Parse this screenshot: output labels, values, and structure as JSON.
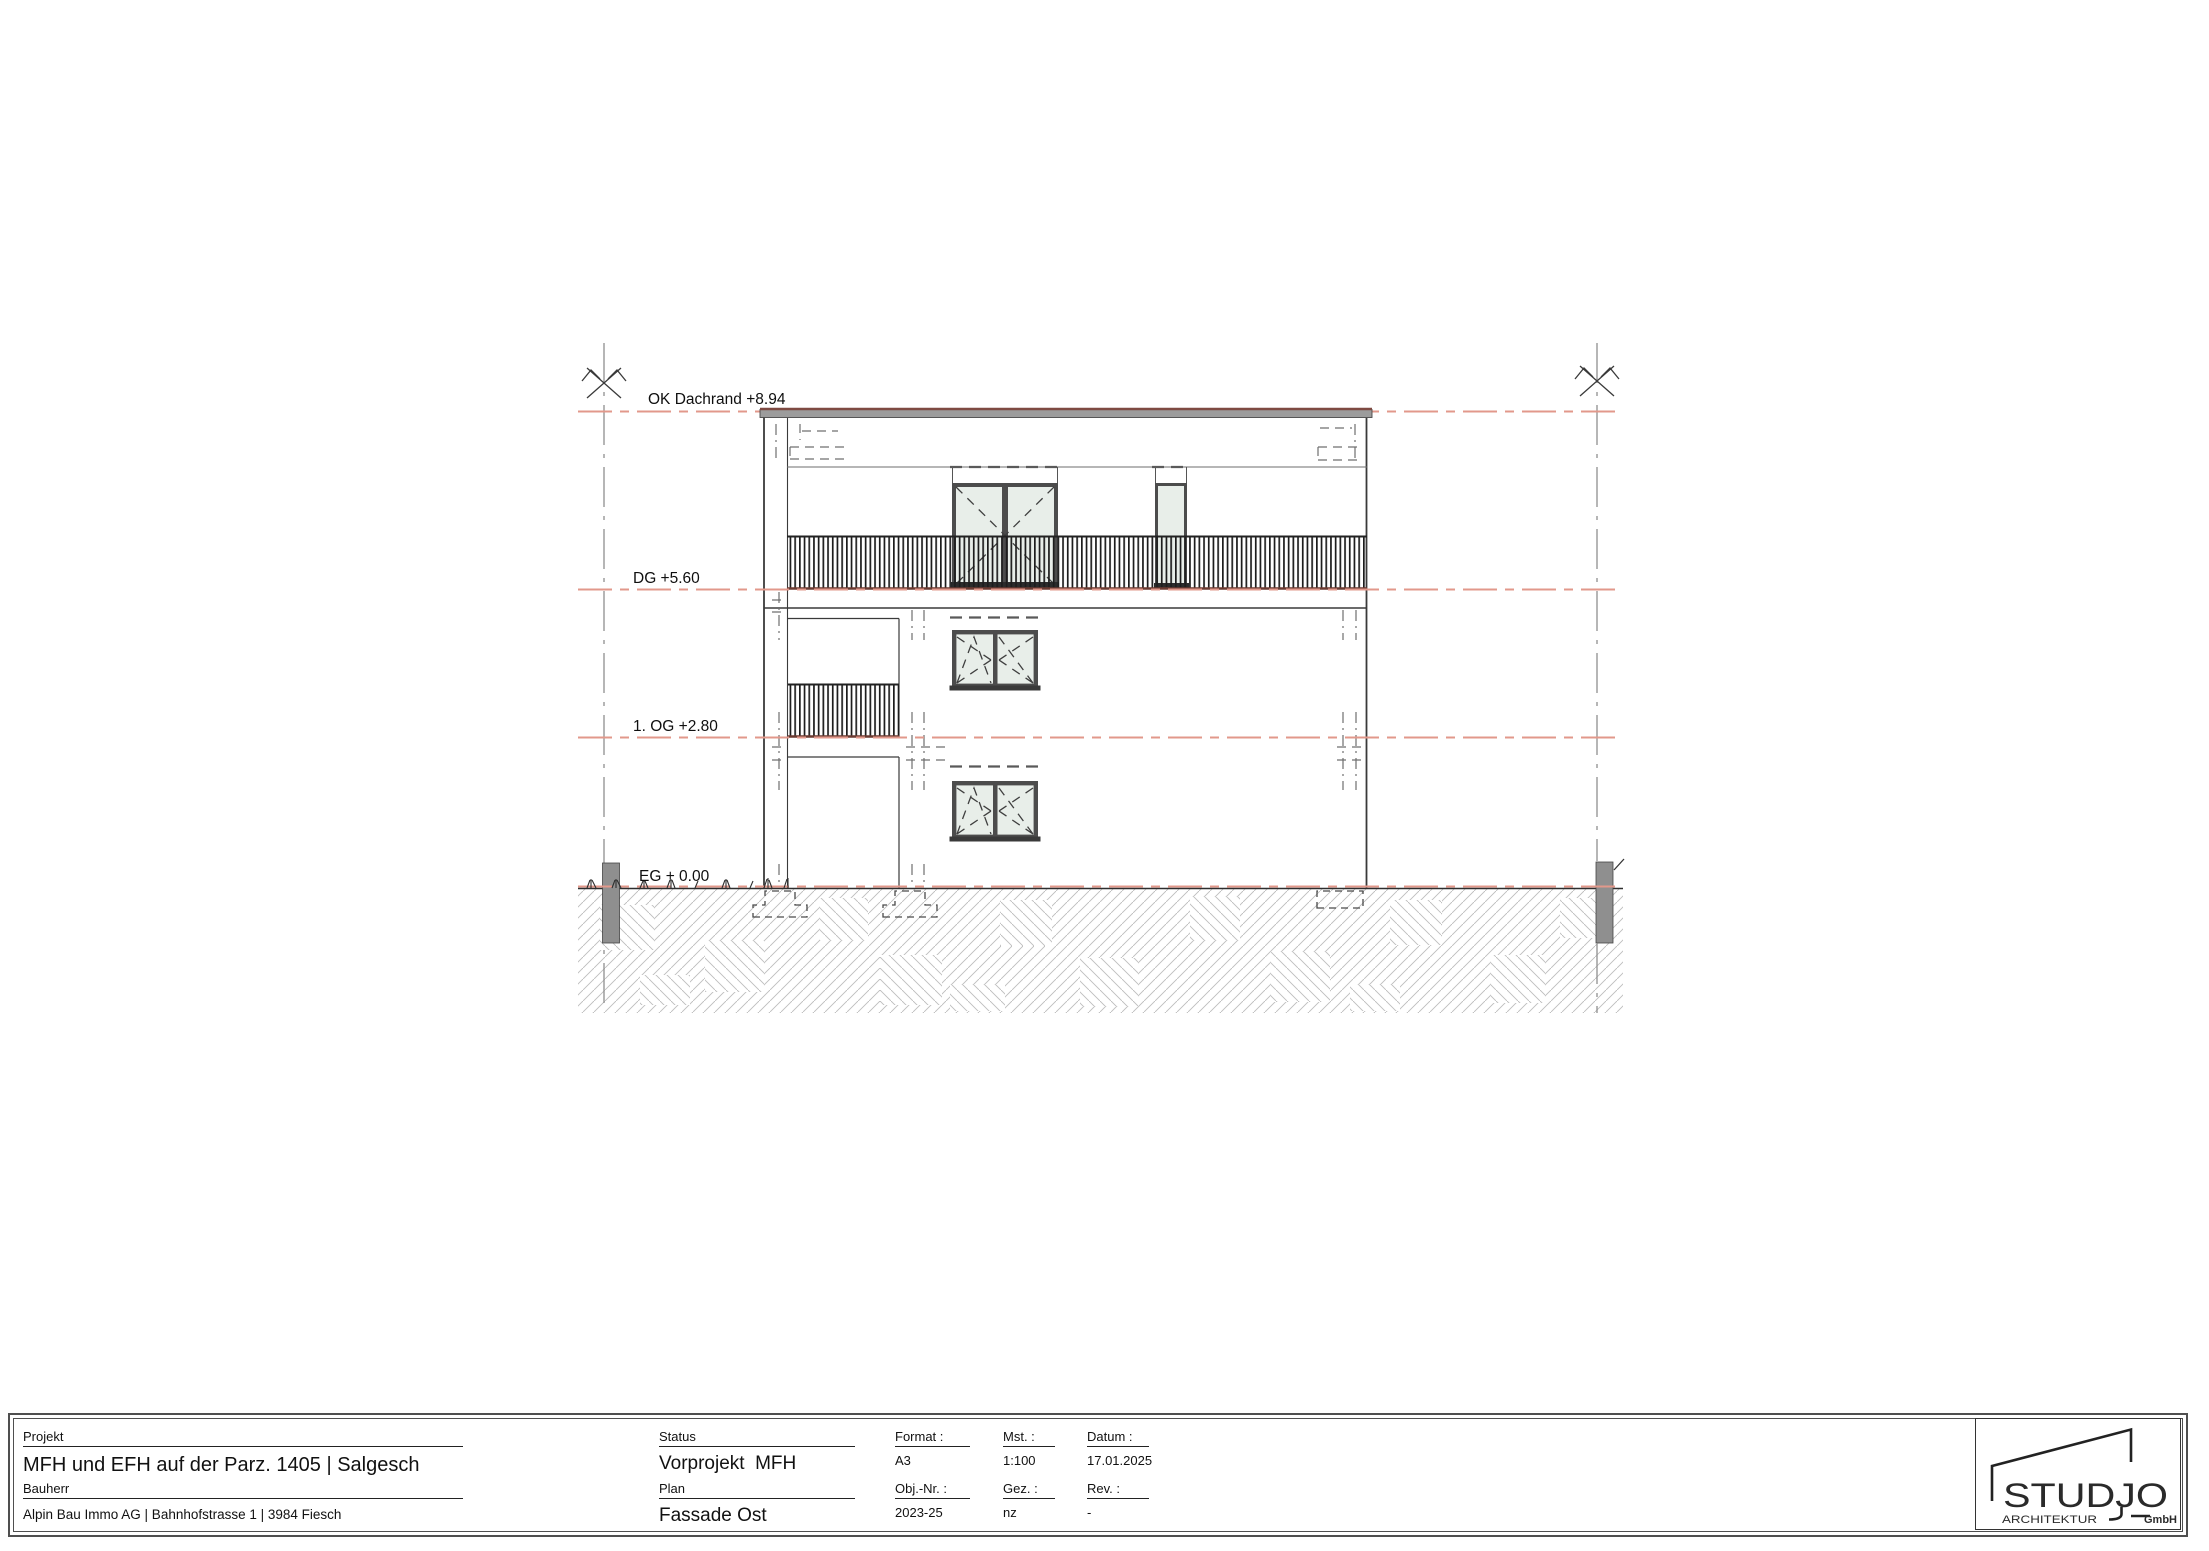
{
  "drawing": {
    "labels": {
      "dachrand": "OK Dachrand +8.94",
      "dg": "DG +5.60",
      "og": "1. OG +2.80",
      "eg": "EG + 0.00"
    },
    "colors": {
      "level_line": "#e2988b",
      "grid_line": "#8f8f8f",
      "glass": "#e8eee9",
      "frame": "#4c4c4c",
      "roof_fill": "#9c9c9c",
      "roof_edge": "#7e4a42",
      "terrace_edge": "#6b3a31",
      "hatch_line": "#bcbcbc"
    }
  },
  "titleblock": {
    "projekt_label": "Projekt",
    "projekt": "MFH und EFH auf der Parz. 1405 | Salgesch",
    "bauherr_label": "Bauherr",
    "bauherr": "Alpin Bau Immo AG | Bahnhofstrasse 1 | 3984 Fiesch",
    "status_label": "Status",
    "status": "Vorprojekt  MFH",
    "plan_label": "Plan",
    "plan": "Fassade Ost",
    "format_label": "Format :",
    "format": "A3",
    "mst_label": "Mst. :",
    "mst": "1:100",
    "datum_label": "Datum :",
    "datum": "17.01.2025",
    "objnr_label": "Obj.-Nr. :",
    "objnr": "2023-25",
    "gez_label": "Gez. :",
    "gez": "nz",
    "rev_label": "Rev. :",
    "rev": "-"
  },
  "logo": {
    "wordmark": "STUDJO",
    "tagline": "ARCHITEKTUR",
    "legal": "GmbH"
  }
}
